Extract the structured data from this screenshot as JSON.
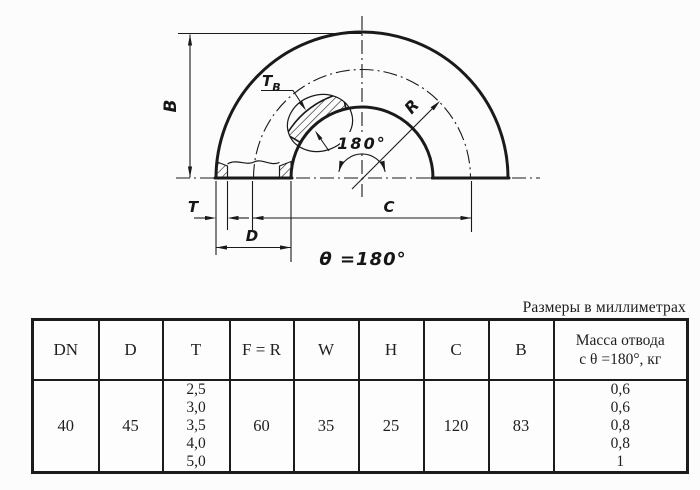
{
  "drawing": {
    "labels": {
      "b": "B",
      "tb_main": "T",
      "tb_sub": "B",
      "angle": "180°",
      "r": "R",
      "t": "T",
      "d": "D",
      "c": "C",
      "theta": "θ =180°"
    }
  },
  "caption": "Размеры в миллиметрах",
  "table": {
    "columns": [
      "DN",
      "D",
      "T",
      "F = R",
      "W",
      "H",
      "C",
      "B"
    ],
    "mass_header": [
      "Масса отвода",
      "с θ =180°, кг"
    ],
    "row": {
      "dn": "40",
      "d": "45",
      "t": [
        "2,5",
        "3,0",
        "3,5",
        "4,0",
        "5,0"
      ],
      "f_r": "60",
      "w": "35",
      "h": "25",
      "c": "120",
      "b": "83",
      "mass": [
        "0,6",
        "0,6",
        "0,8",
        "0,8",
        "1"
      ]
    }
  },
  "colors": {
    "line": "#1a1a1a",
    "background": "#fcfcfc",
    "text": "#1f1f1f"
  }
}
